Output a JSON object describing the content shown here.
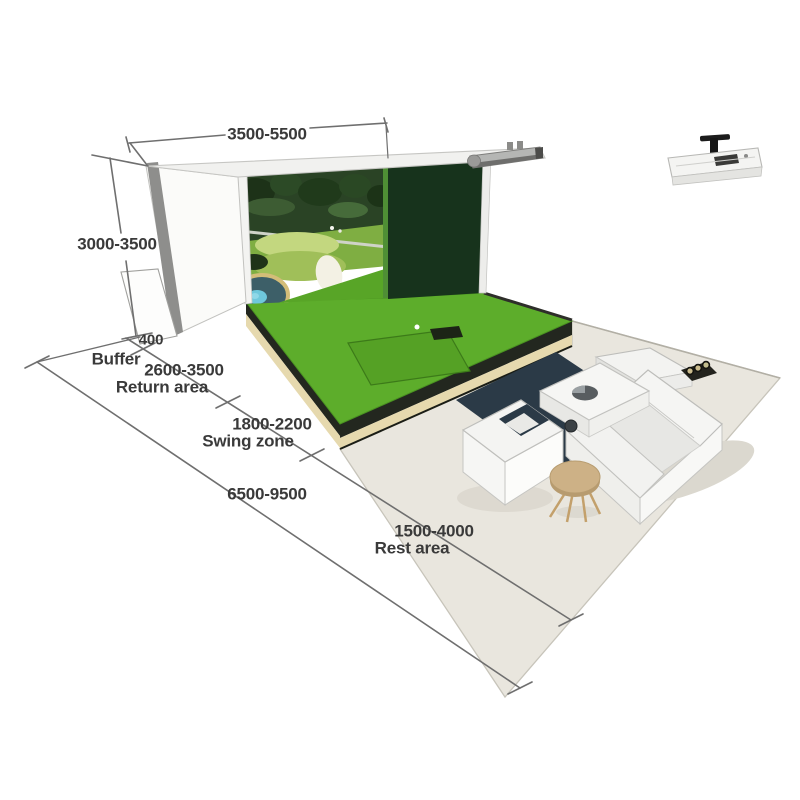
{
  "diagram": {
    "subject": "golf-simulator-room-layout",
    "dimensions": {
      "width_mm": "3500-5500",
      "height_mm": "3000-3500",
      "total_depth_mm": "6500-9500",
      "zones": [
        {
          "label": "Buffer",
          "range": "400"
        },
        {
          "label": "Return area",
          "range": "2600-3500"
        },
        {
          "label": "Swing zone",
          "range": "1800-2200"
        },
        {
          "label": "Rest area",
          "range": "1500-4000"
        }
      ]
    },
    "colors": {
      "turf_green": "#5dad2b",
      "dark_wall_green": "#17331c",
      "floor_beige": "#e9e6de",
      "dimension_line_gray": "#6f6f6f",
      "rug_dark": "#2b3a47",
      "stool_tan": "#cdb186"
    }
  }
}
